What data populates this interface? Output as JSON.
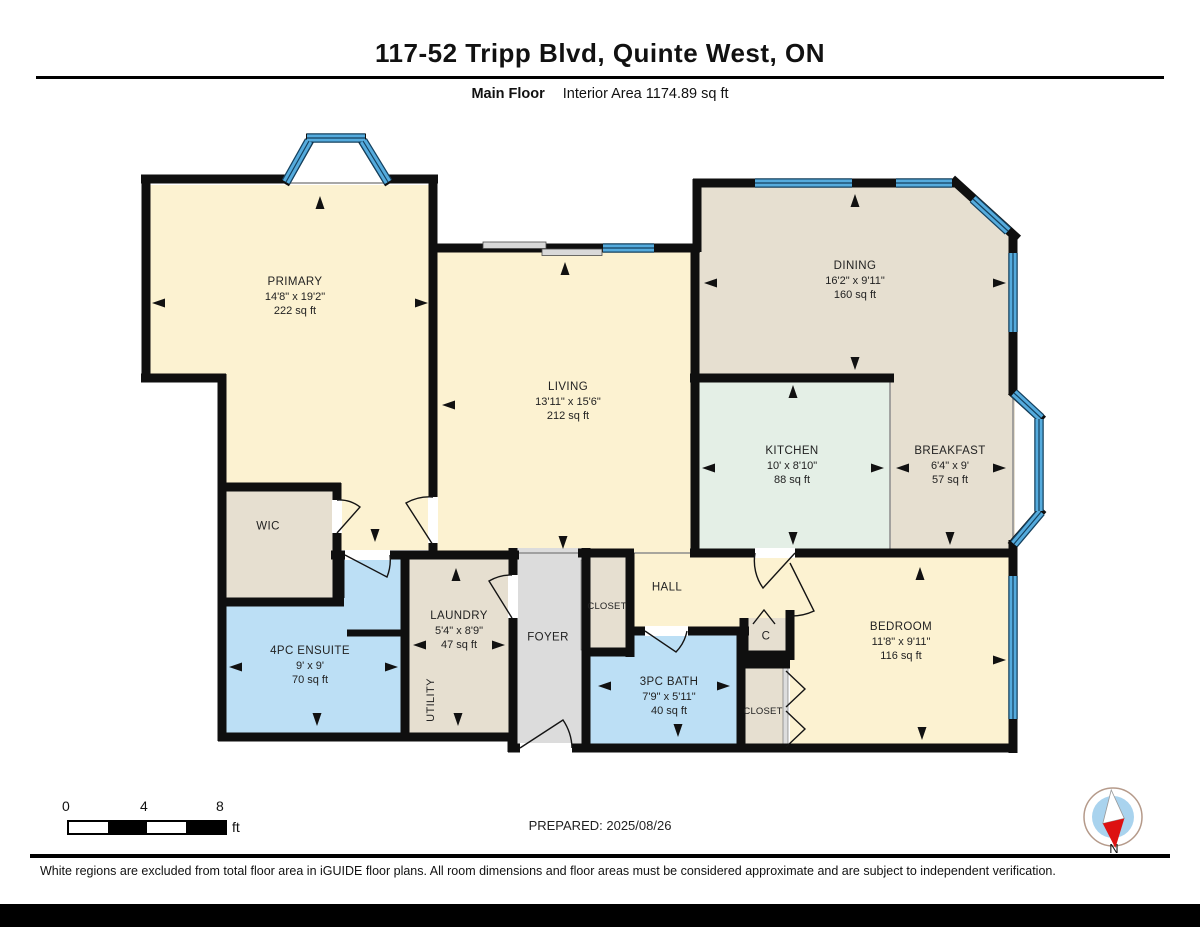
{
  "page": {
    "title": "117-52 Tripp Blvd, Quinte West, ON",
    "floor_label": "Main Floor",
    "area_label": "Interior Area 1174.89 sq ft",
    "prepared_label": "PREPARED: 2025/08/26",
    "disclaimer": "White regions are excluded from total floor area in iGUIDE floor plans. All room dimensions and floor areas must be considered approximate and are subject to independent verification.",
    "compass_label": "N"
  },
  "scale_bar": {
    "tick_0": "0",
    "tick_4": "4",
    "tick_8": "8",
    "unit": "ft"
  },
  "rooms": [
    {
      "name": "PRIMARY",
      "dims": "14'8\" x 19'2\"",
      "area": "222 sq ft"
    },
    {
      "name": "DINING",
      "dims": "16'2\" x 9'11\"",
      "area": "160 sq ft"
    },
    {
      "name": "LIVING",
      "dims": "13'11\" x 15'6\"",
      "area": "212 sq ft"
    },
    {
      "name": "KITCHEN",
      "dims": "10' x 8'10\"",
      "area": "88 sq ft"
    },
    {
      "name": "BREAKFAST",
      "dims": "6'4\" x 9'",
      "area": "57 sq ft"
    },
    {
      "name": "WIC",
      "dims": "",
      "area": ""
    },
    {
      "name": "LAUNDRY",
      "dims": "5'4\" x 8'9\"",
      "area": "47 sq ft"
    },
    {
      "name": "UTILITY",
      "dims": "",
      "area": ""
    },
    {
      "name": "FOYER",
      "dims": "",
      "area": ""
    },
    {
      "name": "CLOSET",
      "dims": "",
      "area": ""
    },
    {
      "name": "HALL",
      "dims": "",
      "area": ""
    },
    {
      "name": "4PC ENSUITE",
      "dims": "9' x 9'",
      "area": "70 sq ft"
    },
    {
      "name": "3PC BATH",
      "dims": "7'9\" x 5'11\"",
      "area": "40 sq ft"
    },
    {
      "name": "C",
      "dims": "",
      "area": ""
    },
    {
      "name": "CLOSET",
      "dims": "",
      "area": ""
    },
    {
      "name": "BEDROOM",
      "dims": "11'8\" x 9'11\"",
      "area": "116 sq ft"
    }
  ],
  "colors": {
    "wall": "#0f0f0f",
    "room_yellow": "#fcf2d1",
    "room_beige": "#e6dfd0",
    "room_mint": "#e4efe6",
    "room_blue": "#bcdff5",
    "room_gray": "#dcdcdc",
    "window_blue": "#55abdd",
    "compass_red": "#dd1111"
  }
}
